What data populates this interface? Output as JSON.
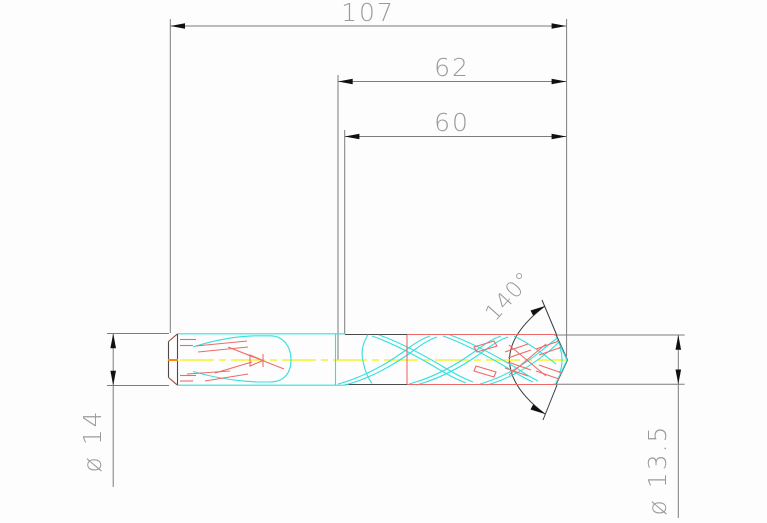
{
  "drawing": {
    "type": "technical-drawing",
    "subject": "coolant-fed twist drill, side view",
    "background": "#fdfdfd"
  },
  "colors": {
    "outline": "#4a4a4a",
    "dimension": "#7c7c7c",
    "text": "#9a9a9a",
    "arrow": "#101010",
    "flute": "#35dede",
    "hidden": "#ee6a6a",
    "centerline": "#f2f200",
    "face_mark": "#ff8c00",
    "chamfer": "#9a4a4a"
  },
  "dimensions": {
    "overall_length": {
      "label": "107",
      "value": 107
    },
    "length_to_flute_start": {
      "label": "62",
      "value": 62
    },
    "flute_length": {
      "label": "60",
      "value": 60
    },
    "point_angle": {
      "label": "140°",
      "value": 140
    },
    "shank_diameter": {
      "label": "ø 14",
      "value": 14
    },
    "cutting_diameter": {
      "label": "ø 13.5",
      "value": 13.5
    }
  }
}
